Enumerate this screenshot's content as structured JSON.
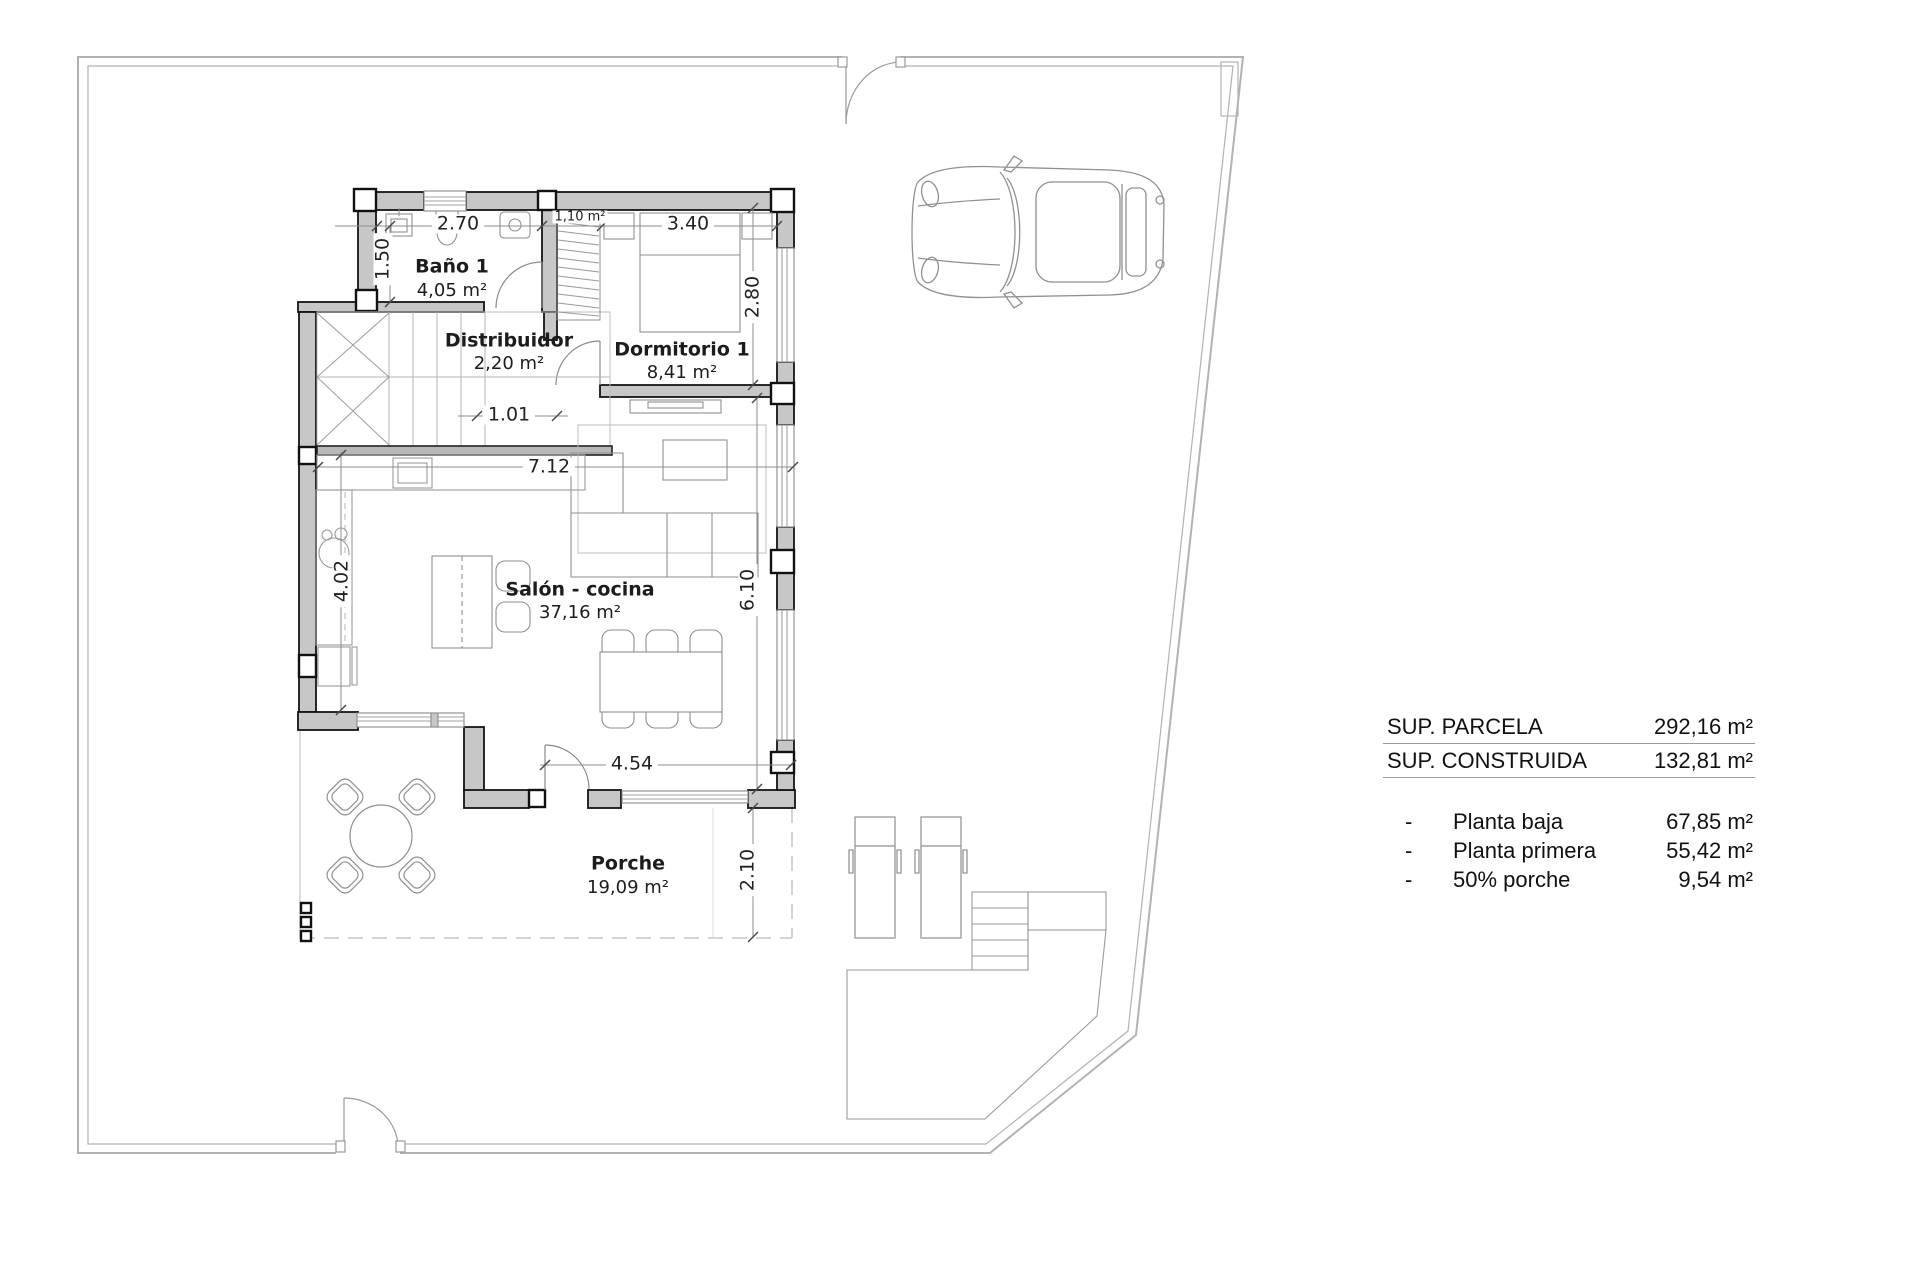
{
  "plan": {
    "rooms": {
      "bano": {
        "name": "Baño 1",
        "area": "4,05 m²"
      },
      "distribuidor": {
        "name": "Distribuidor",
        "area": "2,20 m²"
      },
      "dormitorio": {
        "name": "Dormitorio 1",
        "area": "8,41 m²"
      },
      "salon": {
        "name": "Salón - cocina",
        "area": "37,16 m²"
      },
      "porche": {
        "name": "Porche",
        "area": "19,09 m²"
      },
      "armario": {
        "area": "1,10 m²"
      }
    },
    "dims": {
      "d270": "2.70",
      "d150": "1.50",
      "d340": "3.40",
      "d280": "2.80",
      "d101": "1.01",
      "d712": "7.12",
      "d402": "4.02",
      "d610": "6.10",
      "d454": "4.54",
      "d210": "2.10"
    }
  },
  "summary": {
    "headers": [
      {
        "label": "SUP. PARCELA",
        "value": "292,16 m²"
      },
      {
        "label": "SUP. CONSTRUIDA",
        "value": "132,81 m²"
      }
    ],
    "items": [
      {
        "bullet": "-",
        "label": "Planta baja",
        "value": "67,85 m²"
      },
      {
        "bullet": "-",
        "label": "Planta primera",
        "value": "55,42 m²"
      },
      {
        "bullet": "-",
        "label": "50% porche",
        "value": "9,54 m²"
      }
    ]
  }
}
